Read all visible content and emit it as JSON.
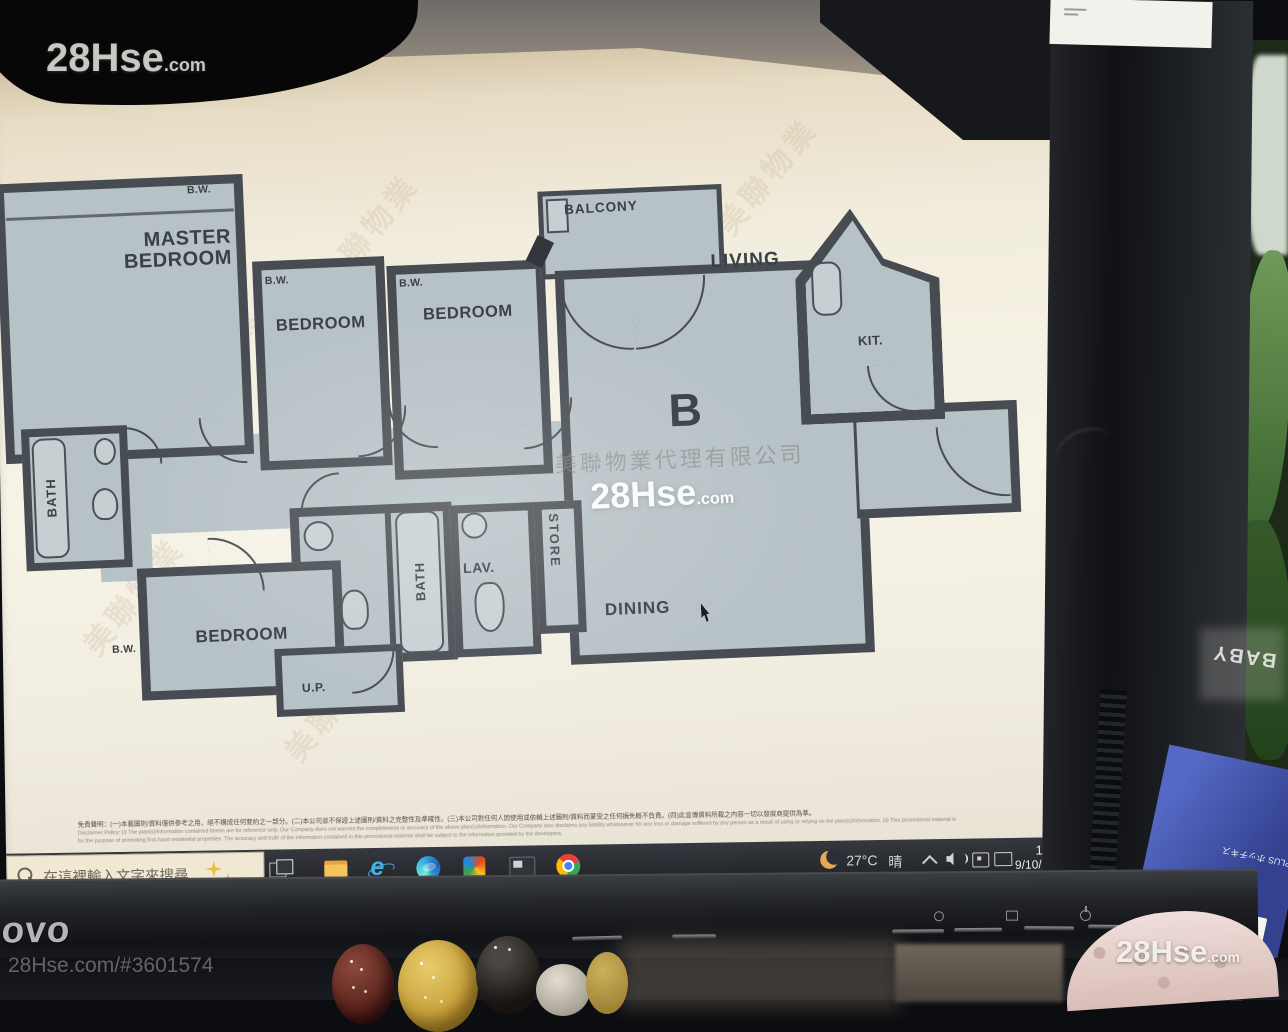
{
  "watermarks": {
    "brand": "28Hse",
    "brand_tld": ".com",
    "listing_url": "28Hse.com/#3601574",
    "agency": "美聯物業代理有限公司",
    "diag": "美聯物業"
  },
  "floor_plan": {
    "unit": "B",
    "rooms": {
      "master_bedroom": "MASTER BEDROOM",
      "bedroom": "BEDROOM",
      "living": "LIVING",
      "dining": "DINING",
      "kitchen": "KIT.",
      "bath": "BATH",
      "lavatory": "LAV.",
      "store": "STORE",
      "balcony": "BALCONY",
      "utility_platform": "U.P.",
      "bay_window": "B.W."
    }
  },
  "disclaimer": {
    "line1": "免責聲明：(一)本載圖則/資料僅供參考之用，絕不構成任何要約之一部分。(二)本公司並不保證上述圖則/資料之完整性及準確性。(三)本公司對任何人因使用或依賴上述圖則/資料而蒙受之任何損失概不負責。(四)此宣傳資料所載之內容一切以發展商提供為準。",
    "line2": "Disclaimer Policy: (i) The plan(s)/information contained herein are for reference only. Our Company does not warrant the completeness or accuracy of the above plan(s)/information. Our Company also disclaims any liability whatsoever for any loss or damage suffered by any person as a result of using or relying on the plan(s)/information. (ii) This promotional material is",
    "line3": "for the purpose of promoting first-hand residential properties. The accuracy and truth of the information contained in this promotional material shall be subject to the information provided by the developers."
  },
  "taskbar": {
    "search_placeholder": "在這裡輸入文字來搜尋",
    "tray": {
      "temperature": "27°C",
      "weather": "晴",
      "time": "19:47",
      "date": "9/10/2025"
    }
  },
  "monitor": {
    "brand": "novo"
  },
  "desk": {
    "package_label": "ス針",
    "package_size": "10",
    "package_brand": "PLUS ホッチキス",
    "baby_text": "BABY"
  },
  "colors": {
    "plan_wall": "#474c52",
    "plan_floor": "#b7c2c6",
    "taskbar": "#2c2f35",
    "search_box": "#f2e9d5",
    "power_led": "#cbe64a"
  }
}
